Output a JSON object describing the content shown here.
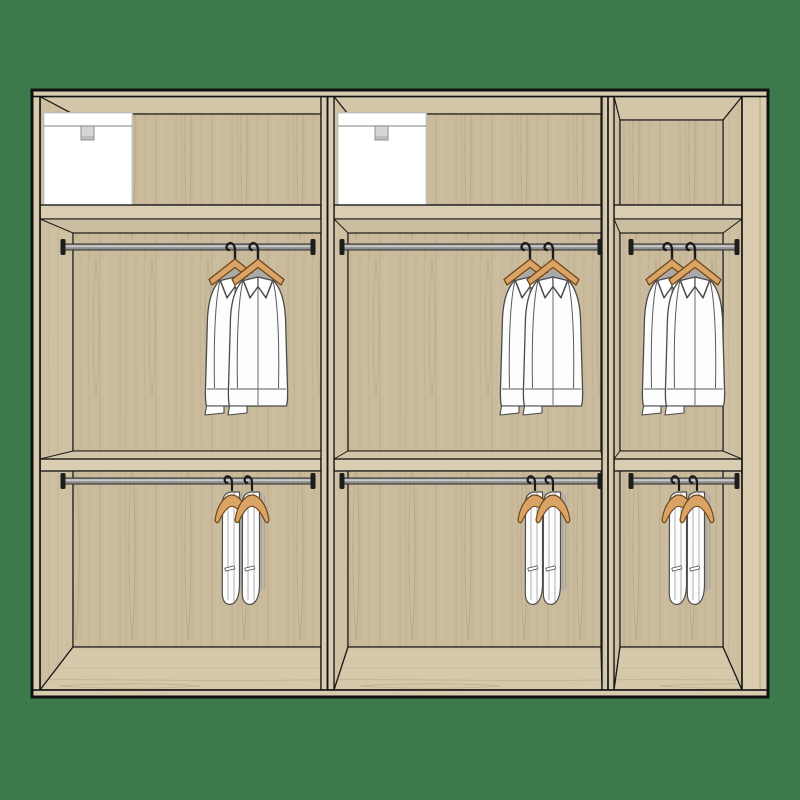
{
  "scene": {
    "description": "Flat illustration of an open wardrobe interior in light oak wood on a green background, three sections with shelves, clothes rails, hanging shirts, hanging trousers and storage boxes",
    "background_color": "#3D7A4B"
  },
  "wardrobe": {
    "material": "light-oak",
    "sections": [
      {
        "id": "left",
        "top_compartment": {
          "items": [
            "storage-box"
          ]
        },
        "upper_rail": {
          "items": [
            "shirt",
            "shirt"
          ]
        },
        "lower_rail": {
          "items": [
            "trousers",
            "trousers"
          ]
        }
      },
      {
        "id": "middle",
        "top_compartment": {
          "items": [
            "storage-box"
          ]
        },
        "upper_rail": {
          "items": [
            "shirt",
            "shirt"
          ]
        },
        "lower_rail": {
          "items": [
            "trousers",
            "trousers"
          ]
        }
      },
      {
        "id": "right",
        "top_compartment": {
          "items": []
        },
        "upper_rail": {
          "items": [
            "shirt",
            "shirt"
          ]
        },
        "lower_rail": {
          "items": [
            "trousers",
            "trousers"
          ]
        }
      }
    ],
    "counts": {
      "sections": 3,
      "shelves_per_section": 2,
      "rails_per_section": 2,
      "storage_boxes": 2,
      "shirts": 6,
      "trousers": 6
    }
  },
  "colors": {
    "bg": "#3D7A4B",
    "wood-edge": "#D8CBAE",
    "wood-shelf": "#DACDB1",
    "wood-back": "#C9BB9C",
    "wood-side": "#CEC0A2",
    "wood-ceil": "#D3C5A7",
    "wood-under": "#CBBD9F",
    "wood-floorband": "#D2C4A6",
    "outline": "#1C1C1C",
    "rail-body": "#8F8F8F",
    "rail-highlight": "#C9C9C9",
    "bracket": "#1D1D1D",
    "hanger": "#D9A466",
    "hanger-outline": "#6F4519",
    "shirt": "#FDFDFD",
    "clothes-outline": "#4B4B4B",
    "box": "#FFFFFF",
    "box-outline": "#BFBFBF",
    "box-handle": "#D6D6D6"
  }
}
